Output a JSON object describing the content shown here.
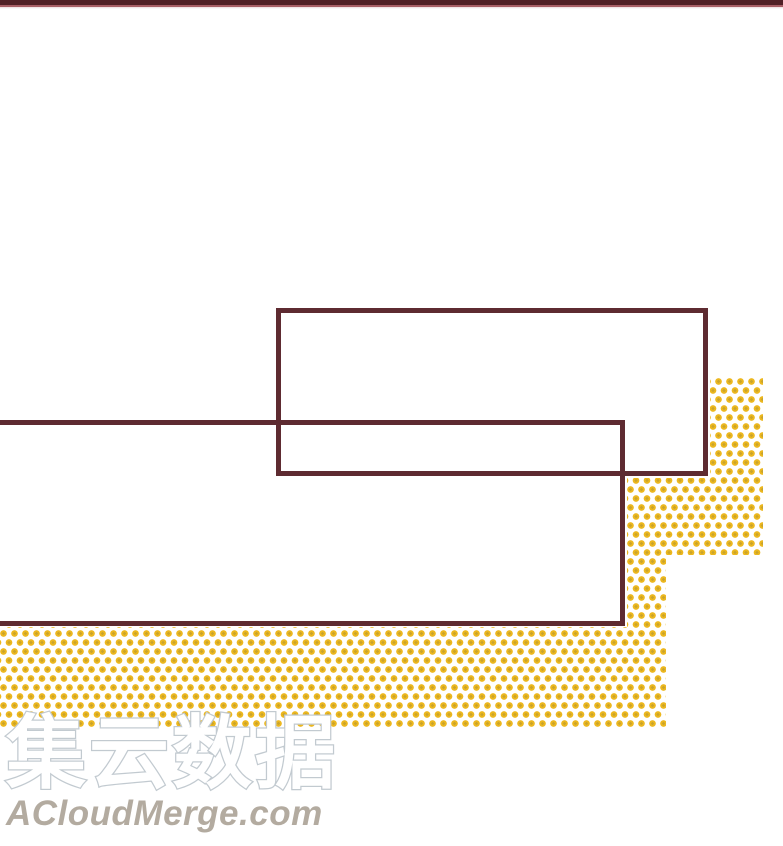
{
  "watermark": {
    "title": "集云数据",
    "site": "ACloudMerge.com"
  },
  "colors": {
    "page_bg": "#ffffff",
    "top_bar_dark": "#512026",
    "top_bar_light": "#a85f66",
    "panel_border": "#5e2b31",
    "dot_outer": "#ecb71e",
    "dot_inner": "#c9a42c",
    "watermark_fill": "#ffffff",
    "watermark_outline": "#c2cad0",
    "site_text": "#b3aba0"
  }
}
